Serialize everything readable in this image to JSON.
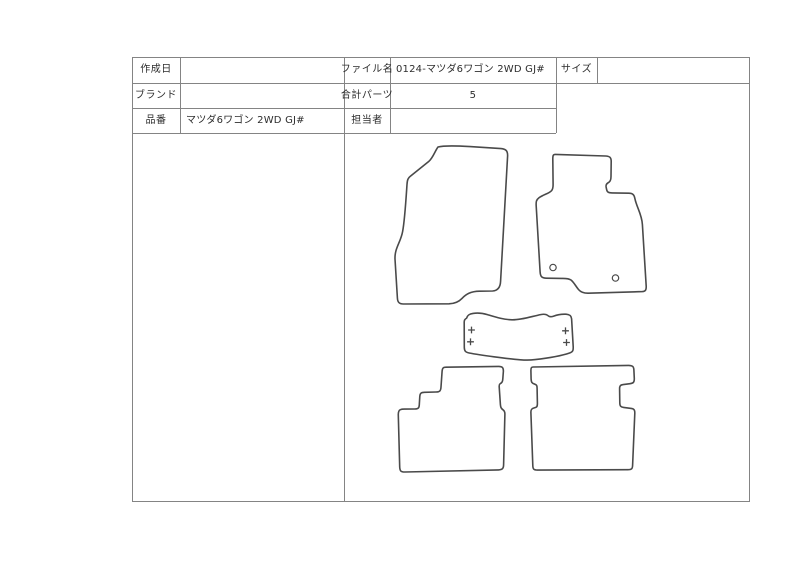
{
  "table": {
    "created_date": {
      "label": "作成日",
      "value": ""
    },
    "brand": {
      "label": "ブランド",
      "value": ""
    },
    "part_number": {
      "label": "品番",
      "value": "マツダ6ワゴン 2WD GJ#"
    },
    "file_name": {
      "label": "ファイル名",
      "value": "0124-マツダ6ワゴン 2WD GJ#"
    },
    "total_parts": {
      "label": "合計パーツ",
      "value": "5"
    },
    "person_in_charge": {
      "label": "担当者",
      "value": ""
    },
    "size": {
      "label": "サイズ",
      "value": ""
    }
  },
  "drawing": {
    "stroke": "#4a4a4a",
    "line_color": "#848484",
    "text_color": "#2d2d2d",
    "mats": [
      {
        "name": "front-driver-mat",
        "path": "M 438 147 C 444 145.5 460 146 470 146.6 L 501 148.6 C 506 149 507.8 151 507.6 156 L 500.6 281 C 500.4 287 498 290.6 492.6 291 L 479.6 291.2 C 470.6 291.3 466 294.2 462 298.4 C 458.6 302 455 303.6 449 303.8 L 403.4 304 C 399 304 397.6 302 397.4 298 L 395 259 C 394.6 248 400.6 242.6 402.6 231.6 C 404.8 220 406.2 196 407 184.4 C 407.3 180 408 178 410.2 176.4 L 429 161.2 C 433 157.8 435 151 438 147 Z"
      },
      {
        "name": "front-passenger-mat",
        "path": "M 555.4 154.4 L 605.6 156 C 609.8 156.2 611.2 157.6 611.2 161.4 L 611 176.6 C 611 180.4 610 181.8 607.8 183 C 606.2 183.9 605.9 185.2 606.1 187 L 606.6 189.4 C 607 192.2 608.6 192.8 612 192.9 L 628.8 193.2 C 632.8 193.3 634.2 194.8 634.8 198.2 C 636.6 207.4 641.8 214 642.4 224.6 L 646.2 286.2 C 646.4 290 645.4 291.4 642.4 291.6 L 588.4 293.2 C 583.8 293.3 581 292.4 578.6 289.6 C 575.4 285.8 574 282.4 571 280 C 568.4 278.2 565.4 278.4 561.8 278.4 L 546.4 278.2 C 541.6 278.1 540.4 276.4 540.1 271.8 L 536.2 206 C 535.9 201.4 536.4 199.8 539 197.8 C 543.6 194.4 549 193.6 551.6 190.6 C 552.8 189.2 553.1 187.4 553.1 184.6 L 552.8 159 C 552.8 155.6 553.2 154.3 555.4 154.4 Z",
        "holes": [
          {
            "cx": 553,
            "cy": 267.5,
            "r": 3.2
          },
          {
            "cx": 615.5,
            "cy": 278,
            "r": 3.2
          }
        ]
      },
      {
        "name": "center-tunnel-mat",
        "path": "M 466.6 318.2 C 467.4 315.2 469.2 314 473 313.4 C 478.8 312.4 483.4 313.4 487.4 314.6 C 495.4 317 503.4 319.6 512 319.8 C 521.6 320 532.4 316.2 540.6 314.6 C 544.4 313.8 546.4 314.2 548.2 315.8 C 549.8 317.2 551.2 317 553.4 316.2 C 558.2 314.4 562.2 314 566 314.2 C 569.8 314.4 571.2 315.8 571.6 318.8 L 573.2 346.6 C 573.4 350.6 572.8 352 569.6 353 C 559.6 356.4 545.6 358.4 535.2 359.6 C 530.4 360.2 525.2 360.2 520.4 359.8 C 507.6 358.8 479.8 355 469.2 353 C 465.4 352.2 464.4 351 464.3 347.4 L 464.2 322 C 464.2 320 465 319 466.6 318.2 Z",
        "plus_marks": [
          {
            "x": 471.5,
            "y": 330
          },
          {
            "x": 470.5,
            "y": 341.8
          },
          {
            "x": 565.5,
            "y": 330.8
          },
          {
            "x": 566.5,
            "y": 342.5
          }
        ]
      },
      {
        "name": "rear-left-mat",
        "path": "M 446 367.2 L 498.8 366.4 C 502.4 366.4 503.4 367.8 503.4 371 L 502.8 379 C 502.7 381.6 502.2 382.6 500.6 383.4 C 499.3 384.1 499.1 384.8 499.2 386.8 L 500.4 404.6 C 500.6 407.2 501 408.4 503 409.8 C 504.6 410.9 504.9 412 504.9 414 L 503.6 464.8 C 503.5 468.6 502.2 469.8 498.6 469.9 L 405 472 C 400.9 472.1 399.9 471 399.7 467 L 398.3 415 C 398.2 411.8 398.7 410.5 400.3 409.7 C 401.4 409.2 402.7 409.1 404.4 409.1 L 414.8 409 C 418.2 409 419.2 408 419.3 404.6 L 419.8 396.4 C 420 393.2 421.2 392.4 424.4 392.3 L 436 392 C 439.8 391.9 440.8 390.8 441 387 L 442.1 371.2 C 442.4 368 443.2 367.2 446 367.2 Z"
      },
      {
        "name": "rear-right-mat",
        "path": "M 533.2 367 L 628.6 365.4 C 632.6 365.4 633.8 366.6 633.9 370.2 L 634.3 378.6 C 634.4 382.2 633.4 383.2 630 383.7 L 623.2 384.6 C 620.2 385 619.5 386 619.6 389.2 L 619.8 402.8 C 619.8 406 620.6 407 623.6 407.4 L 631.2 408.4 C 634.4 408.9 634.9 410.2 634.8 413.4 L 632.6 465.4 C 632.5 469 631.4 469.7 627.8 469.7 L 537.4 470.1 C 533.6 470.1 532.9 469 532.8 465.4 L 530.9 412.6 C 530.8 409.8 531.5 408.6 533.8 408 L 535.8 407.4 C 537.2 407 537.4 405.8 537.4 403.4 L 537.1 388.4 C 537.1 385.8 536.7 384.8 534.8 384.2 C 531.8 383.2 531.2 382.2 531.1 378.8 L 530.9 370.6 C 530.9 367.8 531.4 367 533.2 367 Z"
      }
    ]
  }
}
